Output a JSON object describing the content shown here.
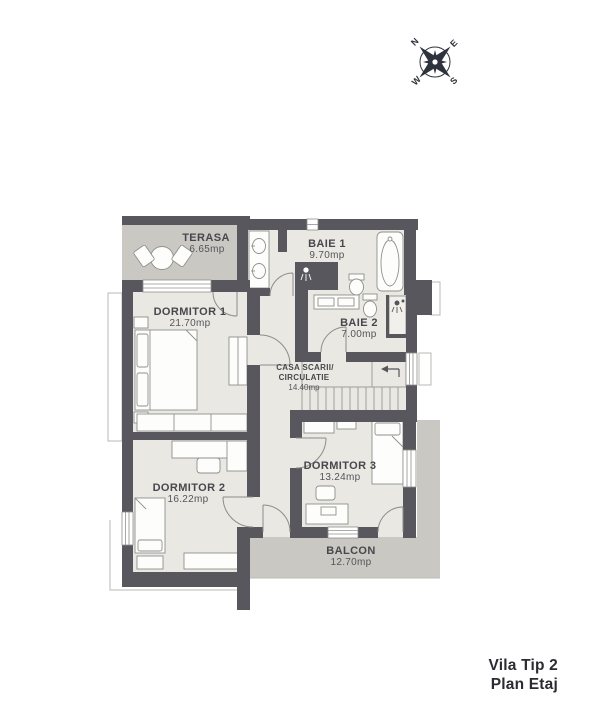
{
  "title": {
    "line1": "Vila Tip 2",
    "line2": "Plan Etaj"
  },
  "compass": {
    "n": "N",
    "e": "E",
    "s": "S",
    "w": "W"
  },
  "rooms": {
    "terasa": {
      "name": "TERASA",
      "area": "6.65mp"
    },
    "baie1": {
      "name": "BAIE 1",
      "area": "9.70mp"
    },
    "dormitor1": {
      "name": "DORMITOR 1",
      "area": "21.70mp"
    },
    "baie2": {
      "name": "BAIE 2",
      "area": "7.00mp"
    },
    "casa_scarii": {
      "name_line1": "CASA SCARII/",
      "name_line2": "CIRCULATIE",
      "area": "14.40mp"
    },
    "dormitor2": {
      "name": "DORMITOR 2",
      "area": "16.22mp"
    },
    "dormitor3": {
      "name": "DORMITOR 3",
      "area": "13.24mp"
    },
    "balcon": {
      "name": "BALCON",
      "area": "12.70mp"
    }
  },
  "colors": {
    "wall": "#57575d",
    "floor": "#e9e8e2",
    "terrace": "#c9c8c2",
    "label_text": "#47474d",
    "title_text": "#2b2b31",
    "compass": "#2e323c",
    "furniture_stroke": "#90908c"
  }
}
